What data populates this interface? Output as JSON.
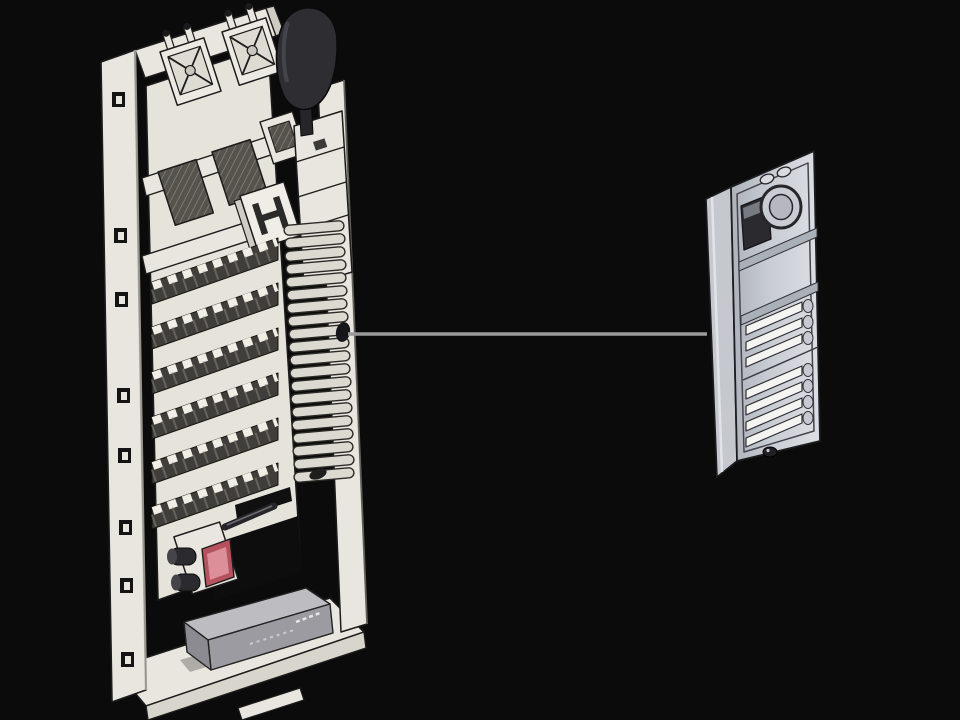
{
  "scene": {
    "kind": "technical-illustration",
    "description_id": "intercom-system-wiring-diagram",
    "background": "#0b0b0b"
  },
  "palette": {
    "background": "#0b0b0b",
    "outline": "#1c1c1c",
    "chassis": "#e9e6df",
    "chassis_shade": "#cfccc3",
    "chassis_dark_shade": "#d8d5cc",
    "plate": "#e6e3db",
    "terminal_band": "#3f3e3a",
    "terminal_tick": "#f1eee6",
    "grille": "#55534c",
    "handset": "#2e2e32",
    "cord": "#dcd9d1",
    "cord_outline": "#2b2a27",
    "lens_red": "#b5525e",
    "lens_red_light": "#dc8f98",
    "module_gray_top": "#bcbcc1",
    "module_gray_front": "#9b9ba1",
    "module_gray_side": "#8b8b91",
    "line": "#9a9a9a",
    "panel_front": "#bfc3ca",
    "panel_front_light": "#d8dbe0",
    "panel_side": "#c5c8ce",
    "panel_outline": "#1d1d20",
    "panel_inner_line": "#45454c",
    "slat": "#f4f4f2",
    "speaker_window": "#2b2b2f",
    "button_bump": "#c6cad0",
    "screw": "#202024"
  },
  "connection": {
    "from_id": "indoor-station-cord",
    "to_id": "door-entry-panel",
    "color": "#9a9a9a"
  },
  "indoor_station": {
    "name_id": "indoor-station-wall-frame",
    "mounting_slot_count": 8,
    "relay_block_count": 2,
    "vent_grille_count": 3,
    "terminal_strip_rows": 6,
    "cord_loop_count": 20,
    "parts": [
      {
        "id": "mounting-flange"
      },
      {
        "id": "top-rail"
      },
      {
        "id": "component-plate"
      },
      {
        "id": "right-column"
      },
      {
        "id": "bottom-tray"
      },
      {
        "id": "relay-block"
      },
      {
        "id": "handset"
      },
      {
        "id": "handset-cradle-bracket"
      },
      {
        "id": "vent-grille"
      },
      {
        "id": "hook-module"
      },
      {
        "id": "coiled-handset-cord"
      },
      {
        "id": "terminal-strip-row"
      },
      {
        "id": "camera-module"
      },
      {
        "id": "power-module-box"
      }
    ]
  },
  "door_station": {
    "name_id": "door-entry-panel",
    "call_buttons_top_group": 3,
    "call_buttons_bottom_group": 4,
    "parts": [
      {
        "id": "panel-side-face"
      },
      {
        "id": "panel-front-face"
      },
      {
        "id": "speaker-window"
      },
      {
        "id": "camera-ring"
      },
      {
        "id": "led-oval"
      },
      {
        "id": "nameplate-section"
      },
      {
        "id": "call-button-slat"
      },
      {
        "id": "button-bump"
      },
      {
        "id": "bottom-screw"
      }
    ]
  }
}
